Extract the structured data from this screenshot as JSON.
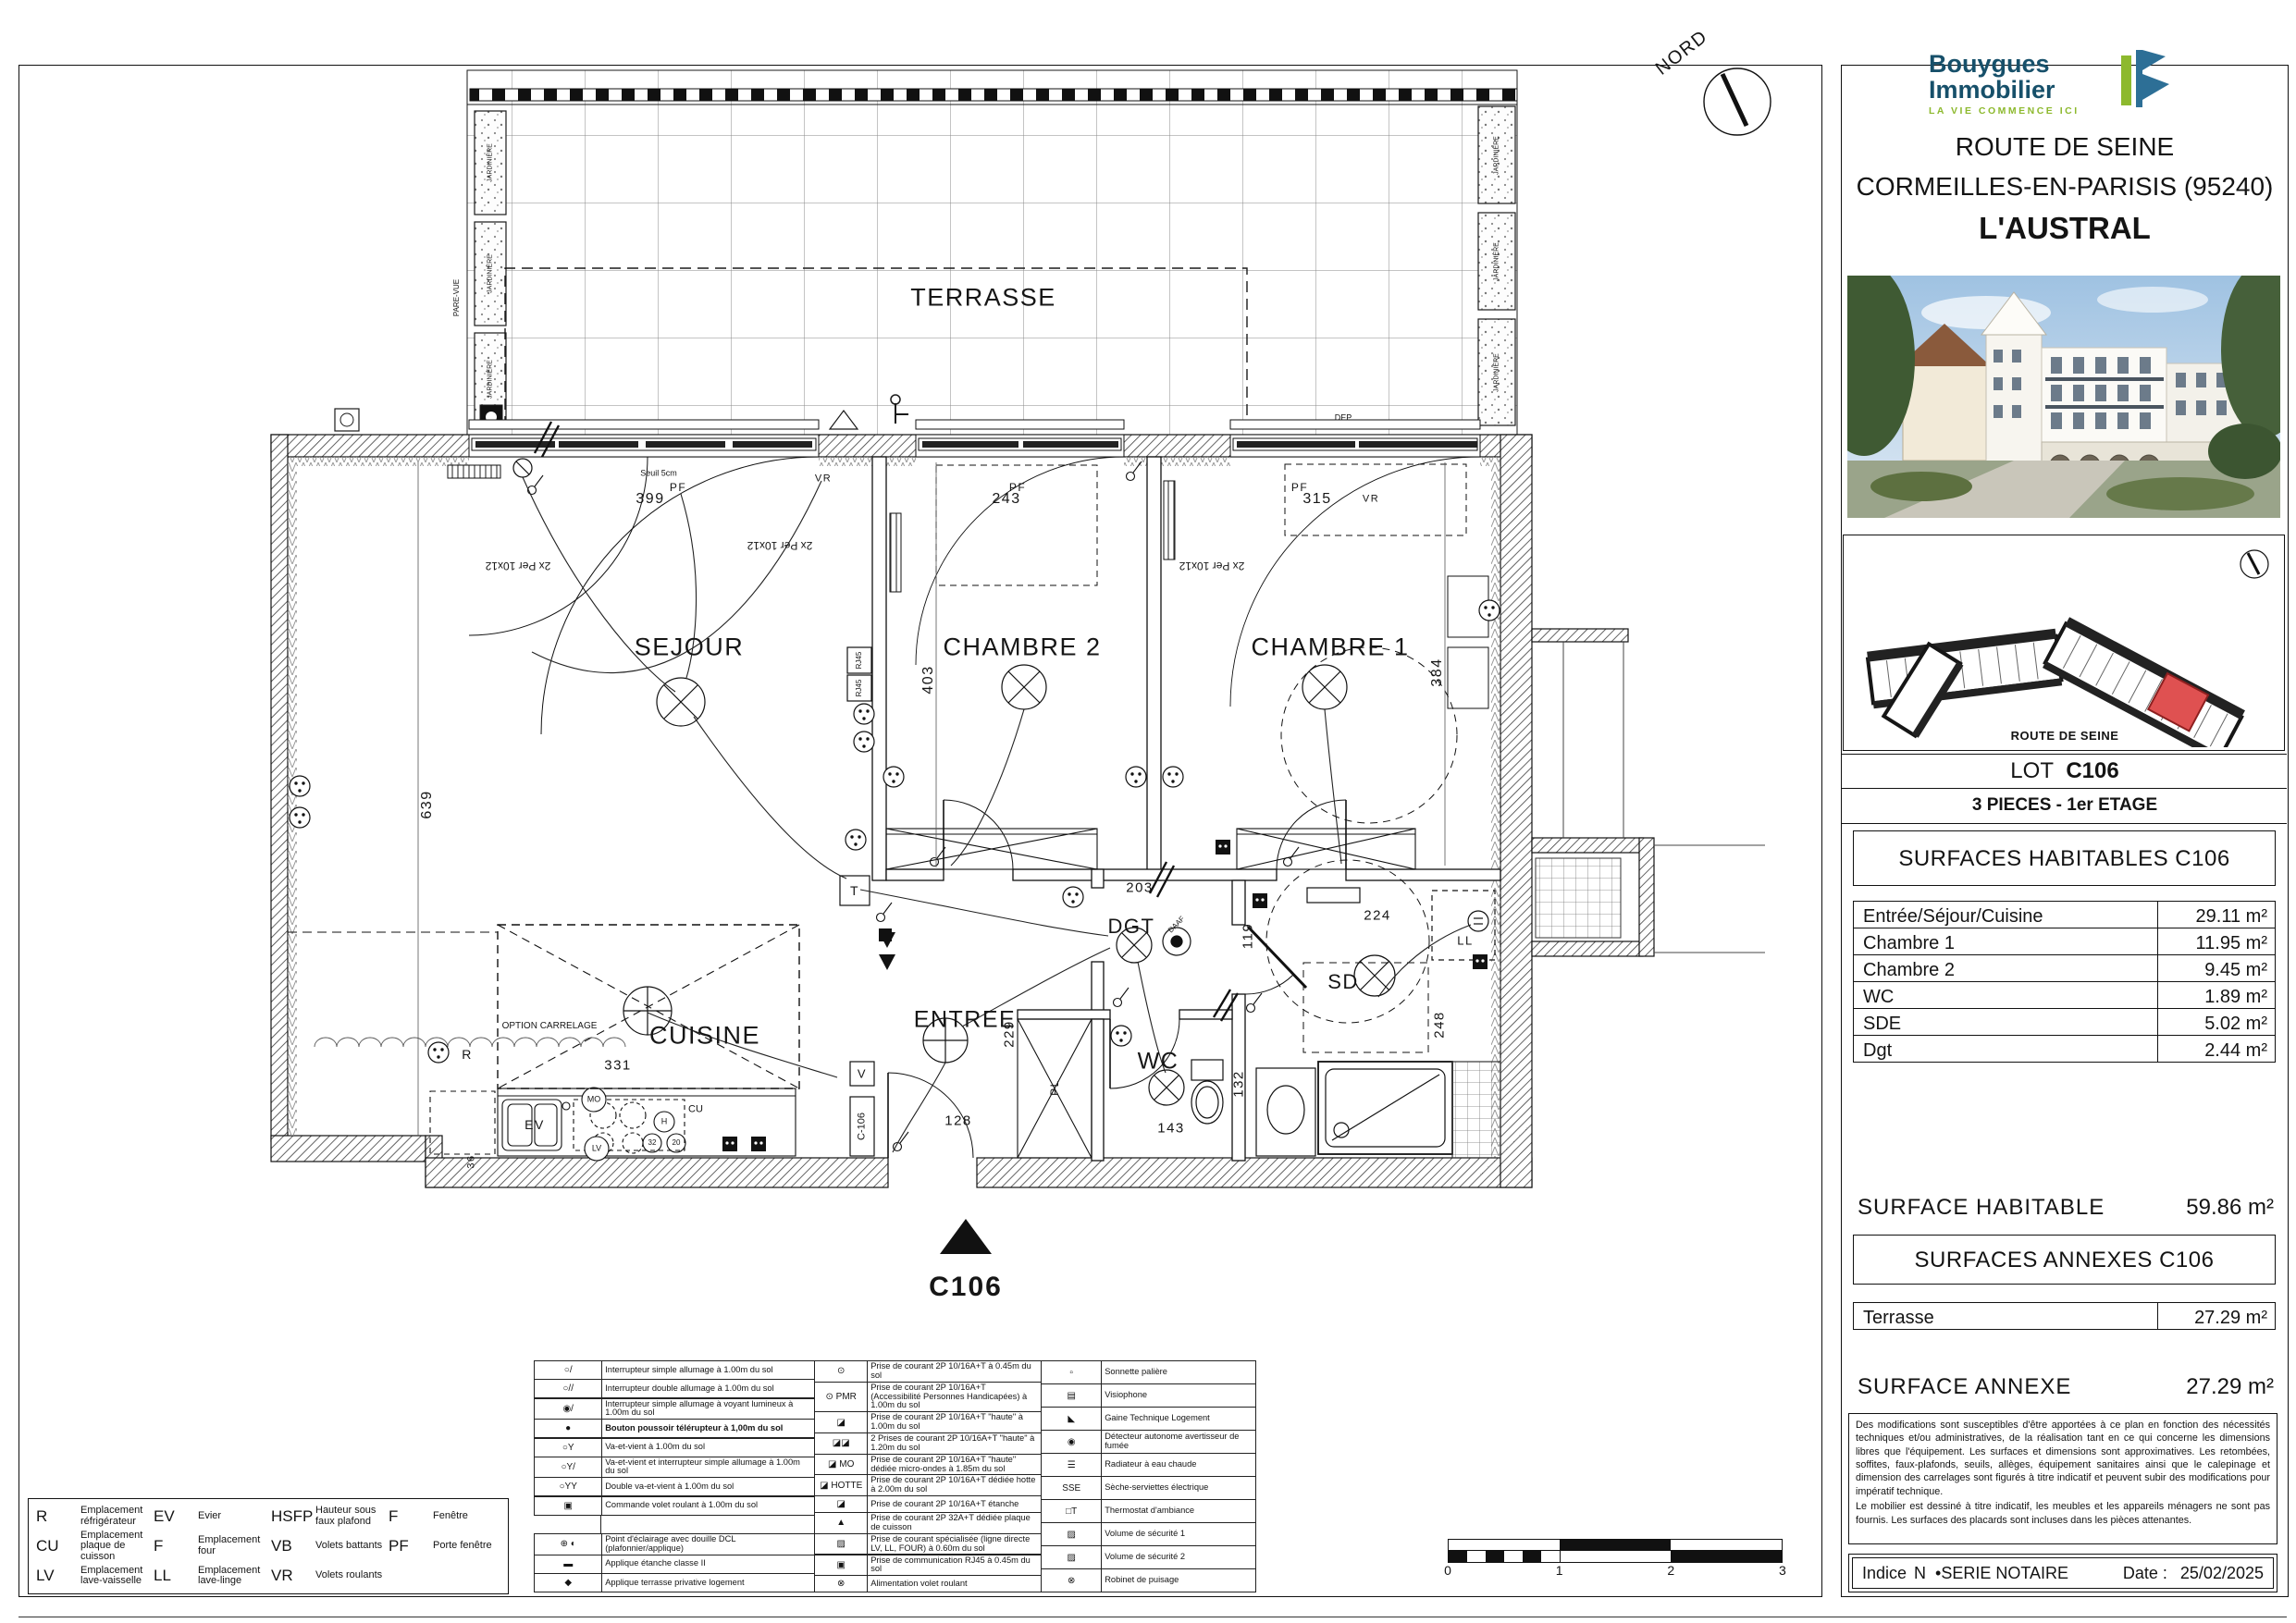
{
  "panel": {
    "logo": {
      "line1": "Bouygues",
      "line2": "Immobilier",
      "tagline": "LA VIE COMMENCE ICI"
    },
    "project": {
      "line1": "ROUTE DE SEINE",
      "line2": "CORMEILLES-EN-PARISIS (95240)",
      "name": "L'AUSTRAL"
    },
    "keyplan": {
      "caption": "ROUTE DE SEINE"
    },
    "lot": {
      "label": "LOT",
      "number": "C106",
      "type": "3 PIECES - 1er ETAGE"
    },
    "surfaces": {
      "title": "SURFACES HABITABLES C106",
      "rows": [
        {
          "label": "Entrée/Séjour/Cuisine",
          "value": "29.11 m²"
        },
        {
          "label": "Chambre 1",
          "value": "11.95 m²"
        },
        {
          "label": "Chambre 2",
          "value": "9.45 m²"
        },
        {
          "label": "WC",
          "value": "1.89 m²"
        },
        {
          "label": "SDE",
          "value": "5.02 m²"
        },
        {
          "label": "Dgt",
          "value": "2.44 m²"
        }
      ],
      "total_label": "SURFACE HABITABLE",
      "total_value": "59.86 m²"
    },
    "annexes": {
      "title": "SURFACES ANNEXES  C106",
      "rows": [
        {
          "label": "Terrasse",
          "value": "27.29 m²"
        }
      ],
      "total_label": "SURFACE ANNEXE",
      "total_value": "27.29 m²"
    },
    "disclaimer": {
      "p1": "Des modifications sont susceptibles d'être apportées à ce plan en fonction des nécessités techniques et/ou administratives, de la réalisation tant en ce qui concerne les dimensions libres que l'équipement. Les surfaces et dimensions sont approximatives. Les retombées, soffites, faux-plafonds, seuils, allèges, équipement sanitaires ainsi que le calepinage et dimension des carrelages sont figurés à titre indicatif et peuvent subir des modifications pour impératif technique.",
      "p2": "Le mobilier est dessiné à titre indicatif, les meubles et les appareils ménagers ne sont pas fournis. Les surfaces des placards sont incluses dans les pièces attenantes."
    },
    "footer": {
      "indice_label": "Indice",
      "indice_value": "N",
      "serie": "•SERIE NOTAIRE",
      "date_label": "Date :",
      "date_value": "25/02/2025"
    }
  },
  "plan": {
    "north": "NORD",
    "marker": {
      "id": "C106"
    },
    "rooms": {
      "terrasse": "TERRASSE",
      "sejour": "SEJOUR",
      "chambre2": "CHAMBRE 2",
      "chambre1": "CHAMBRE 1",
      "cuisine": "CUISINE",
      "entree": "ENTREE",
      "wc": "WC",
      "sde": "SD",
      "dgt": "DGT"
    },
    "dims": {
      "d399": "399",
      "d243": "243",
      "d315": "315",
      "d639": "639",
      "d403": "403",
      "d384": "384",
      "d203": "203",
      "d224": "224",
      "d119": "119",
      "d248": "248",
      "d132": "132",
      "d143": "143",
      "d331": "331",
      "d229": "229",
      "d128": "128",
      "d36": "36"
    },
    "tags": {
      "seuil": "Seuil 5cm",
      "pf": "PF",
      "vr": "VR",
      "per": "2x Per 10x12",
      "ev": "EV",
      "r": "R",
      "mo": "MO",
      "lv": "LV",
      "cu": "CU",
      "h": "H",
      "n32": "32",
      "n20": "20",
      "ll": "LL",
      "v": "V",
      "t": "T",
      "pl": "PL",
      "c106_door": "C-106",
      "rj45": "RJ45",
      "daaf": "DAAF",
      "option": "OPTION CARRELAGE",
      "pare_vue": "PARE-VUE",
      "jardiniere": "JARDINIÈRE",
      "dep": "DEP"
    }
  },
  "scalebar": {
    "ticks": [
      "0",
      "1",
      "2",
      "3"
    ]
  },
  "legend": {
    "col1": [
      {
        "sym": "○/",
        "label": "Interrupteur simple allumage à 1.00m du sol"
      },
      {
        "sym": "○//",
        "label": "Interrupteur double allumage à 1.00m du sol"
      },
      {
        "sym": "◉/",
        "label": "Interrupteur simple allumage à voyant lumineux à 1.00m du sol"
      },
      {
        "sym": "●",
        "label": "Bouton poussoir télérupteur à 1,00m du sol",
        "cls": "b"
      },
      {
        "sym": "○Y",
        "label": "Va-et-vient à 1.00m du sol"
      },
      {
        "sym": "○Y/",
        "label": "Va-et-vient et interrupteur simple allumage à 1.00m du sol"
      },
      {
        "sym": "○YY",
        "label": "Double va-et-vient à 1.00m du sol"
      },
      {
        "sym": "▣",
        "label": "Commande volet roulant à 1.00m du sol"
      },
      {
        "sym": "",
        "label": "",
        "cls": "empty"
      },
      {
        "sym": "⊕ ◐",
        "label": "Point d'éclairage avec douille DCL (plafonnier/applique)"
      },
      {
        "sym": "▬",
        "label": "Applique étanche classe II"
      },
      {
        "sym": "◆",
        "label": "Applique terrasse privative logement"
      }
    ],
    "col2": [
      {
        "sym": "⊙",
        "label": "Prise de courant 2P 10/16A+T à 0.45m du sol"
      },
      {
        "sym": "⊙ PMR",
        "label": "Prise de courant 2P 10/16A+T (Accessibilité Personnes Handicapées) à 1.00m du sol"
      },
      {
        "sym": "◪",
        "label": "Prise de courant 2P 10/16A+T \"haute\" à 1.00m du sol"
      },
      {
        "sym": "◪◪",
        "label": "2 Prises de courant 2P 10/16A+T \"haute\" à 1.20m du sol"
      },
      {
        "sym": "◪ MO",
        "label": "Prise de courant 2P 10/16A+T \"haute\" dédiée micro-ondes à 1.85m du sol"
      },
      {
        "sym": "◪ HOTTE",
        "label": "Prise de courant 2P 10/16A+T dédiée hotte à 2.00m du sol"
      },
      {
        "sym": "◪",
        "label": "Prise de courant 2P 10/16A+T étanche"
      },
      {
        "sym": "▲",
        "label": "Prise de courant 2P 32A+T dédiée plaque de cuisson"
      },
      {
        "sym": "▨",
        "label": "Prise de courant spécialisée (ligne directe LV, LL, FOUR) à 0.60m du sol"
      },
      {
        "sym": "▣",
        "label": "Prise de communication RJ45 à 0.45m du sol"
      },
      {
        "sym": "⊗",
        "label": "Alimentation volet roulant"
      }
    ],
    "col3": [
      {
        "sym": "▫",
        "label": "Sonnette palière"
      },
      {
        "sym": "▤",
        "label": "Visiophone"
      },
      {
        "sym": "◣",
        "label": "Gaine Technique Logement"
      },
      {
        "sym": "◉",
        "label": "Détecteur autonome avertisseur de fumée"
      },
      {
        "sym": "☰",
        "label": "Radiateur à eau chaude"
      },
      {
        "sym": "SSE",
        "label": "Sèche-serviettes électrique"
      },
      {
        "sym": "□T",
        "label": "Thermostat d'ambiance"
      },
      {
        "sym": "▨",
        "label": "Volume de sécurité 1"
      },
      {
        "sym": "▨",
        "label": "Volume de sécurité 2"
      },
      {
        "sym": "⊗",
        "label": "Robinet de puisage"
      }
    ]
  },
  "abbreviations": [
    {
      "code": "R",
      "label": "Emplacement réfrigérateur"
    },
    {
      "code": "CU",
      "label": "Emplacement plaque de cuisson"
    },
    {
      "code": "LV",
      "label": "Emplacement lave-vaisselle"
    },
    {
      "code": "EV",
      "label": "Evier"
    },
    {
      "code": "F",
      "label": "Emplacement four"
    },
    {
      "code": "LL",
      "label": "Emplacement lave-linge"
    },
    {
      "code": "HSFP",
      "label": "Hauteur sous faux plafond"
    },
    {
      "code": "VB",
      "label": "Volets battants"
    },
    {
      "code": "VR",
      "label": "Volets roulants"
    },
    {
      "code": "F",
      "label": "Fenêtre"
    },
    {
      "code": "PF",
      "label": "Porte fenêtre"
    }
  ]
}
